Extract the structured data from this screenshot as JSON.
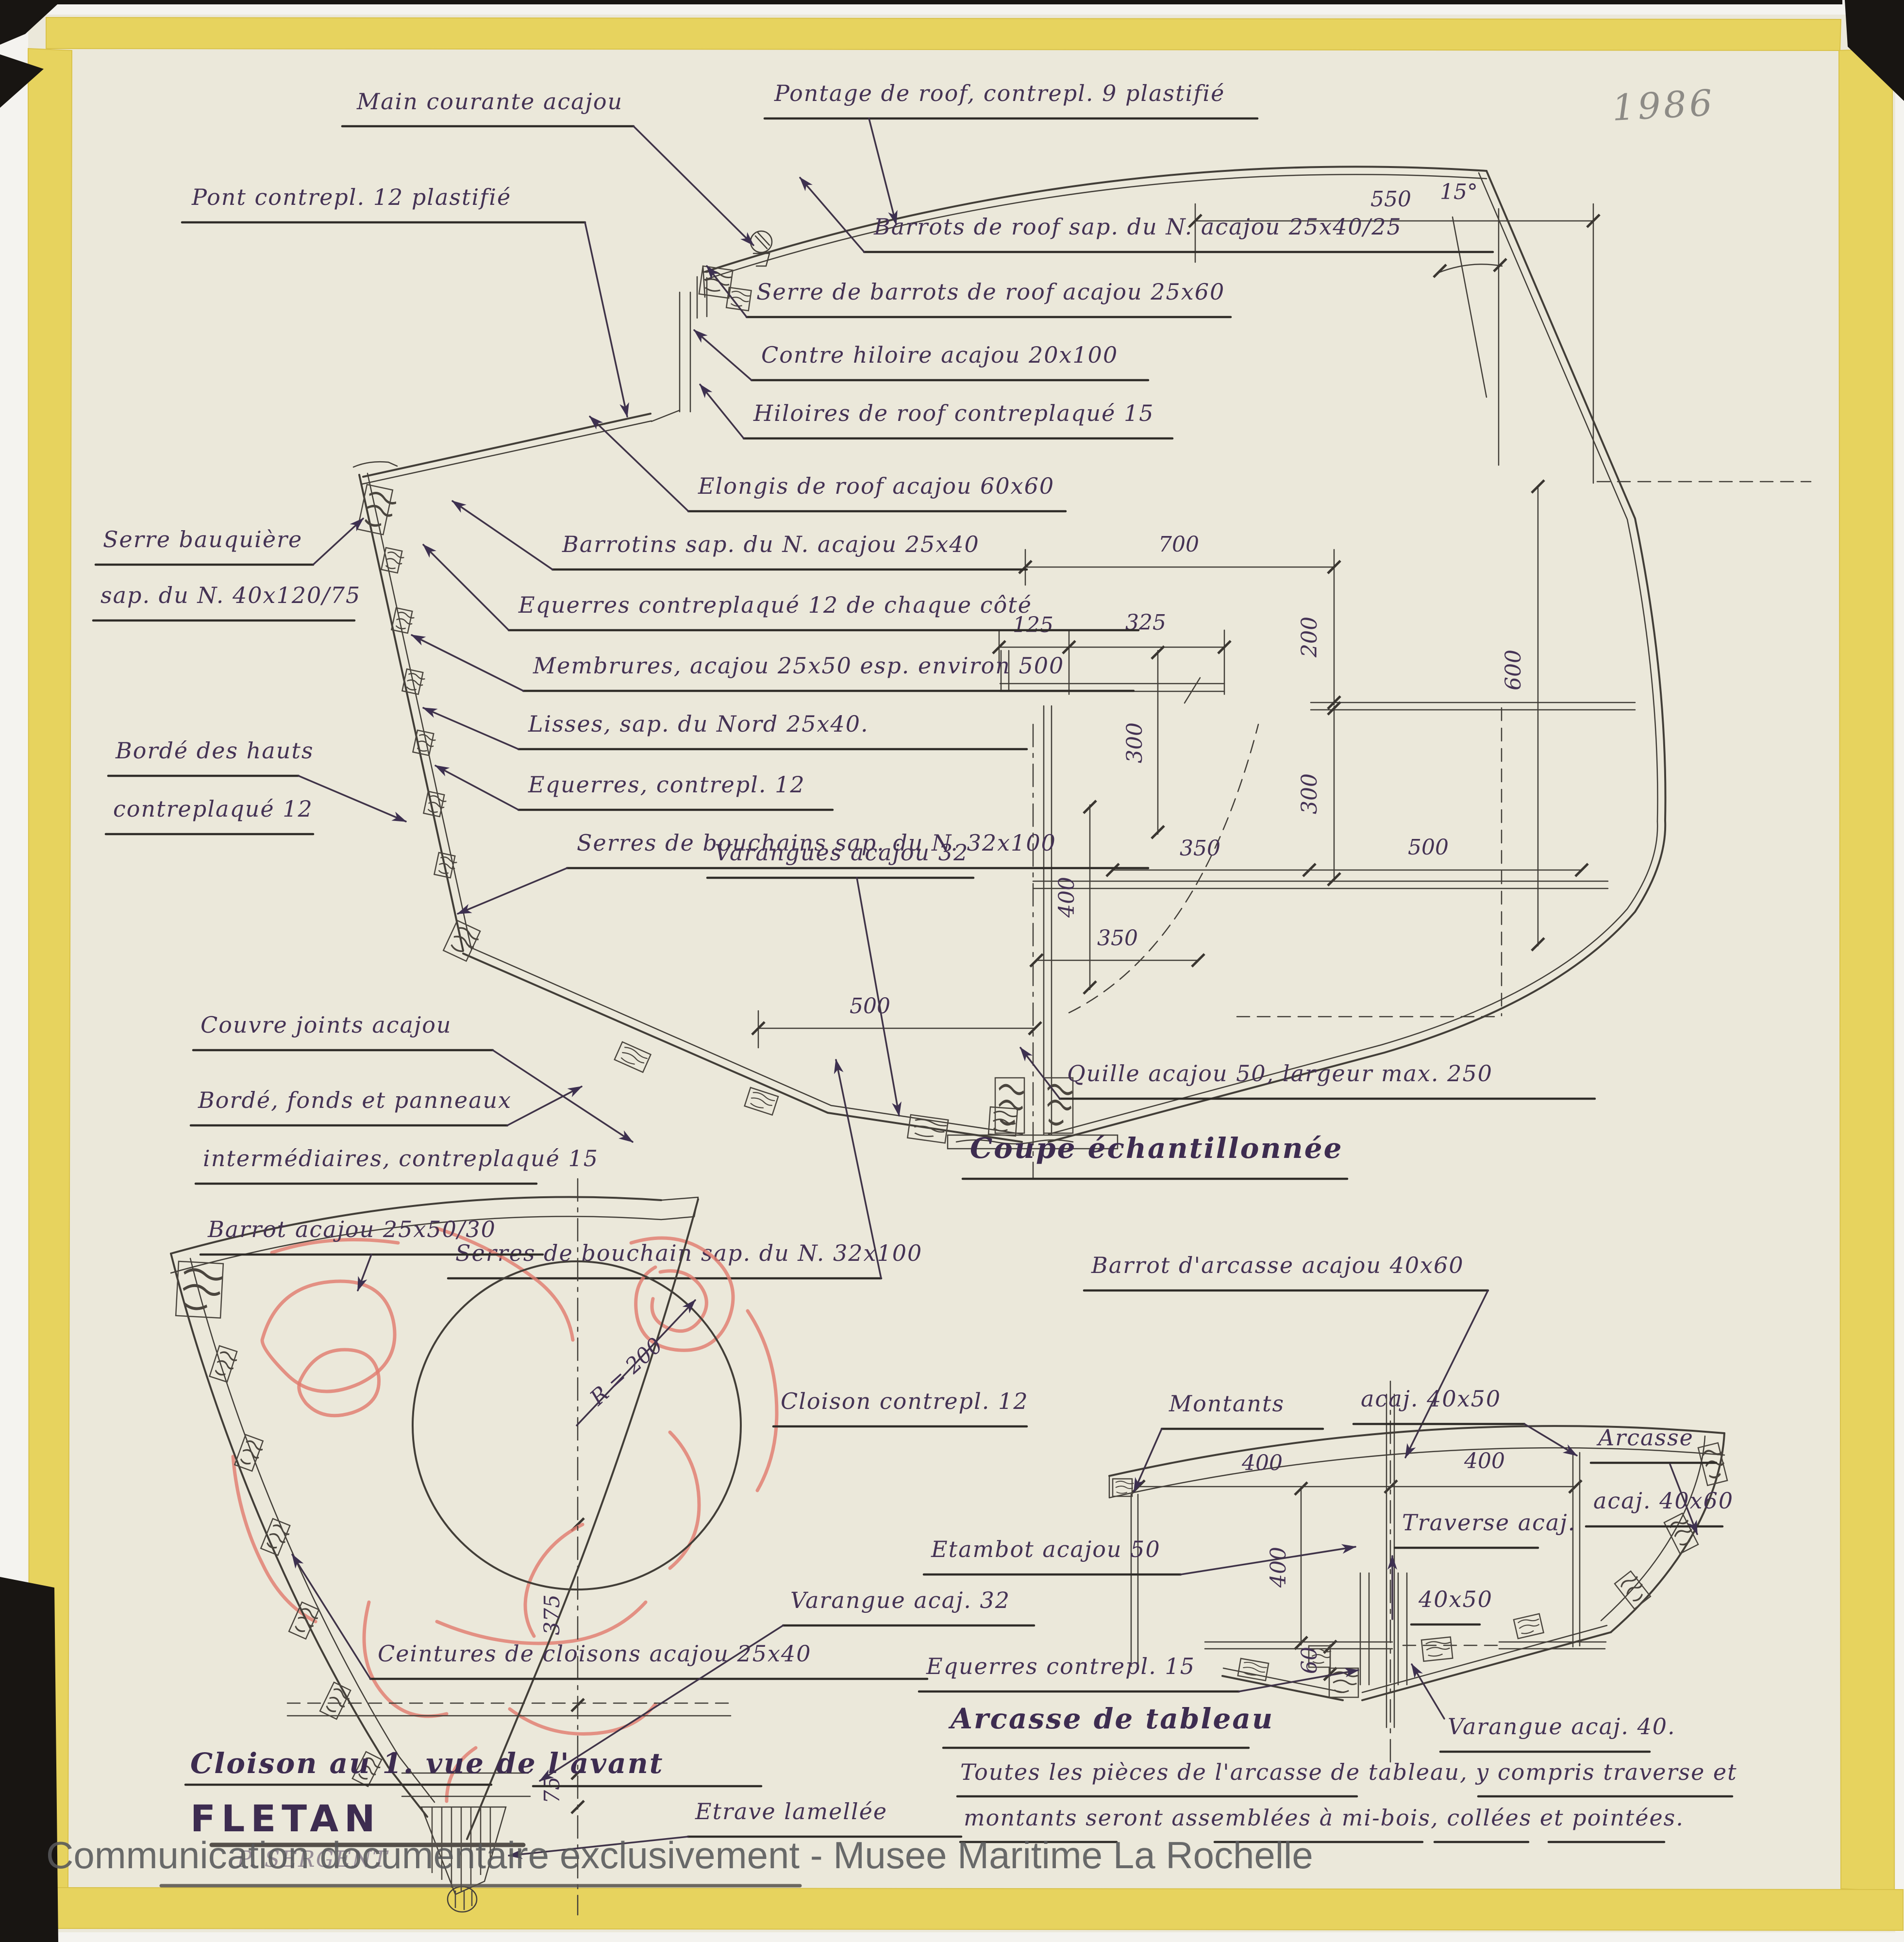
{
  "page": {
    "year_note": "1986",
    "watermark": "Communication documentaire exclusivement - Musee Maritime La Rochelle"
  },
  "coupe": {
    "title": "Coupe échantillonnée",
    "labels": {
      "main_courante": "Main courante acajou",
      "pontage": "Pontage de roof, contrepl. 9 plastifié",
      "pont": "Pont contrepl. 12 plastifié",
      "barrots_roof": "Barrots de roof sap. du N. acajou 25x40/25",
      "serre_barrots": "Serre de barrots de roof acajou 25x60",
      "contre_hiloire": "Contre hiloire acajou 20x100",
      "hiloires": "Hiloires de roof contreplaqué 15",
      "elongis": "Elongis de roof acajou 60x60",
      "barrotins": "Barrotins sap. du N. acajou 25x40",
      "equerres_cote": "Equerres contreplaqué 12 de chaque côté",
      "membrures": "Membrures, acajou 25x50 esp. environ 500",
      "lisses": "Lisses, sap. du Nord 25x40.",
      "equerres_12": "Equerres, contrepl. 12",
      "serres_bouchains": "Serres de bouchains sap. du N. 32x100",
      "serre_bauquiere_1": "Serre bauquière",
      "serre_bauquiere_2": "sap. du N. 40x120/75",
      "borde_hauts_1": "Bordé des hauts",
      "borde_hauts_2": "contreplaqué 12",
      "couvre_joints": "Couvre joints acajou",
      "borde_fonds_1": "Bordé, fonds et panneaux",
      "borde_fonds_2": "intermédiaires, contreplaqué 15",
      "serre_bouchain_bas": "Serres de bouchain sap. du N. 32x100",
      "varangues": "Varangues acajou 32",
      "quille": "Quille acajou 50, largeur max. 250"
    },
    "dims": {
      "d550": "550",
      "d700": "700",
      "d125": "125",
      "d325": "325",
      "d200": "200",
      "d600": "600",
      "d300_gauche": "300",
      "d300_droite": "300",
      "d400_quille": "400",
      "d350_milieu": "350",
      "d500_milieu": "500",
      "d350_bas": "350",
      "d500_bas": "500",
      "angle": "15°"
    }
  },
  "cloison": {
    "title": "Cloison au 1. vue de l'avant",
    "boat_name": "FLETAN",
    "signature": "P. SERGENT",
    "labels": {
      "barrot": "Barrot acajou 25x50/30",
      "cloison": "Cloison contrepl. 12",
      "ceintures": "Ceintures de cloisons acajou 25x40",
      "varangue": "Varangue acaj. 32",
      "etrave": "Etrave lamellée",
      "rayon": "R = 200"
    },
    "dims": {
      "d375": "375",
      "d75": "75"
    }
  },
  "arcasse": {
    "title": "Arcasse de tableau",
    "labels": {
      "barrot_arcasse": "Barrot d'arcasse acajou 40x60",
      "montants": "Montants",
      "montants_section": "acaj. 40x50",
      "arcasse_1": "Arcasse",
      "arcasse_2": "acaj. 40x60",
      "etambot": "Etambot acajou 50",
      "equerres": "Equerres contrepl. 15",
      "traverse_1": "Traverse acaj.",
      "traverse_2": "40x50",
      "varangue": "Varangue acaj. 40."
    },
    "dims": {
      "d400_gauche": "400",
      "d400_droite": "400",
      "d400_vertical": "400",
      "d60": "60"
    },
    "note_1": "Toutes les pièces de l'arcasse de tableau, y compris traverse et",
    "note_2": "montants seront assemblées à mi-bois, collées et pointées."
  },
  "colors": {
    "ink": "#443254",
    "line": "#423e38",
    "red_pencil": "#e07c6f",
    "tape": "#e7d35e",
    "paper": "#ebe8da",
    "watermark": "#57585a"
  }
}
